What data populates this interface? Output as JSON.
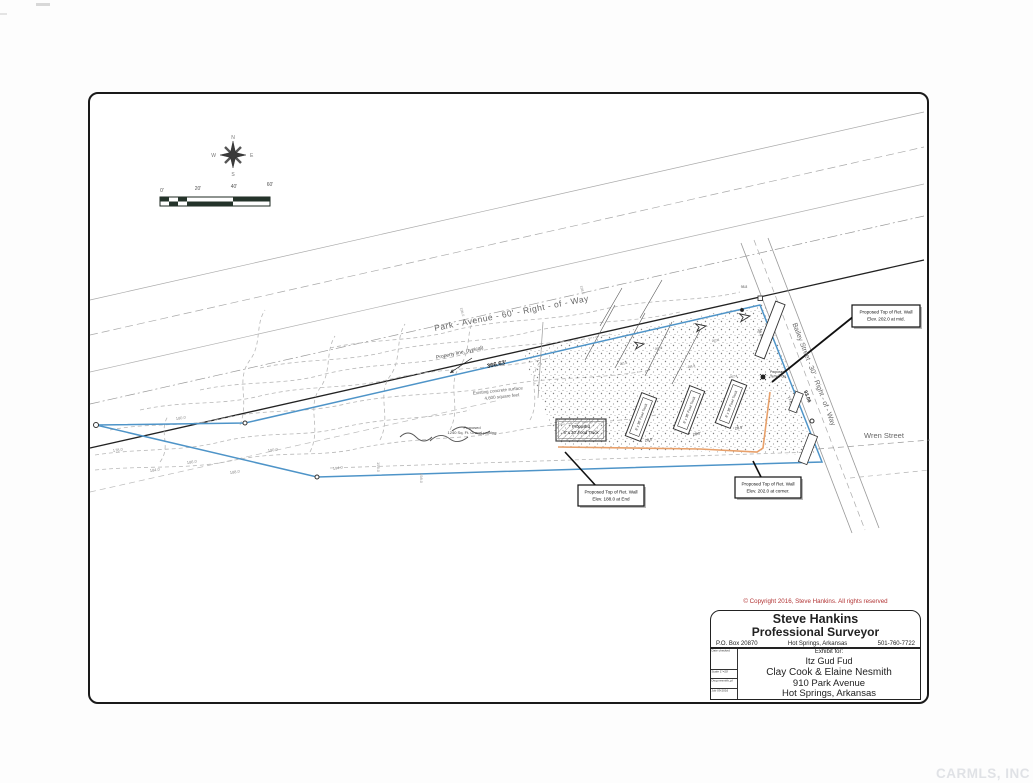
{
  "compass": {
    "n": "N",
    "e": "E",
    "s": "S",
    "w": "W"
  },
  "scalebar": {
    "t0": "0'",
    "t1": "20'",
    "t2": "40'",
    "t3": "60'"
  },
  "streets": {
    "park_avenue": "Park - Avenue - 60' - Right - of - Way",
    "bailey": "Bailey Street - 30' - Right - of - Way",
    "wren": "Wren Street"
  },
  "dims": {
    "frontage_park": "366.63'",
    "frontage_bailey": "93.06",
    "stall": "28.0'",
    "drive": "28.0",
    "d17": "17.8",
    "d98": "98.8"
  },
  "notes": {
    "property_line": "Property line, (typical)",
    "concrete_l1": "Existing concrete surface",
    "concrete_l2": "4,600 square feet",
    "gravel_l1": "Proposed",
    "gravel_l2": "1240 Sq. Ft. Gravel parking",
    "food_truck_l1": "Proposed",
    "food_truck_l2": "8' x 30' Food Truck",
    "temp_pole_l1": "Proposed",
    "temp_pole_l2": "Temp Pole",
    "stall_label": "8' x 30' Food Truck"
  },
  "callouts": {
    "end_l1": "Proposed Top of Ret. Wall",
    "end_l2": "Elev. 188.0 at End",
    "corner_l1": "Proposed Top of Ret. Wall",
    "corner_l2": "Elev. 202.0 at corner.",
    "mid_l1": "Proposed Top of Ret. Wall",
    "mid_l2": "Elev. 202.0 at mid."
  },
  "contours": [
    "178.0",
    "180.0",
    "184.0",
    "186.0",
    "188.0",
    "190.0",
    "194.0",
    "196.0",
    "198.0"
  ],
  "spots": [
    "201.6",
    "202.0",
    "201.8",
    "202.3",
    "202.4"
  ],
  "titleblock": {
    "copyright": "© Copyright 2016, Steve Hankins. All rights reserved",
    "name": "Steve Hankins",
    "profession": "Professional Surveyor",
    "po_box": "P.O. Box 20870",
    "city": "Hot Springs, Arkansas",
    "phone": "501-760-7722",
    "exhibit_for": "Exhibit for:",
    "client": "Itz Gud Fud",
    "owners": "Clay Cook & Elaine Nesmith",
    "address": "910 Park Avenue",
    "address_city": "Hot Springs, Arkansas",
    "cell_1": "Date checked",
    "cell_2": "Scale 1\"=20'",
    "cell_3": "Dwg nesmith_pl",
    "cell_4": "Job 09-2016"
  },
  "watermark": "CARMLS, INC"
}
